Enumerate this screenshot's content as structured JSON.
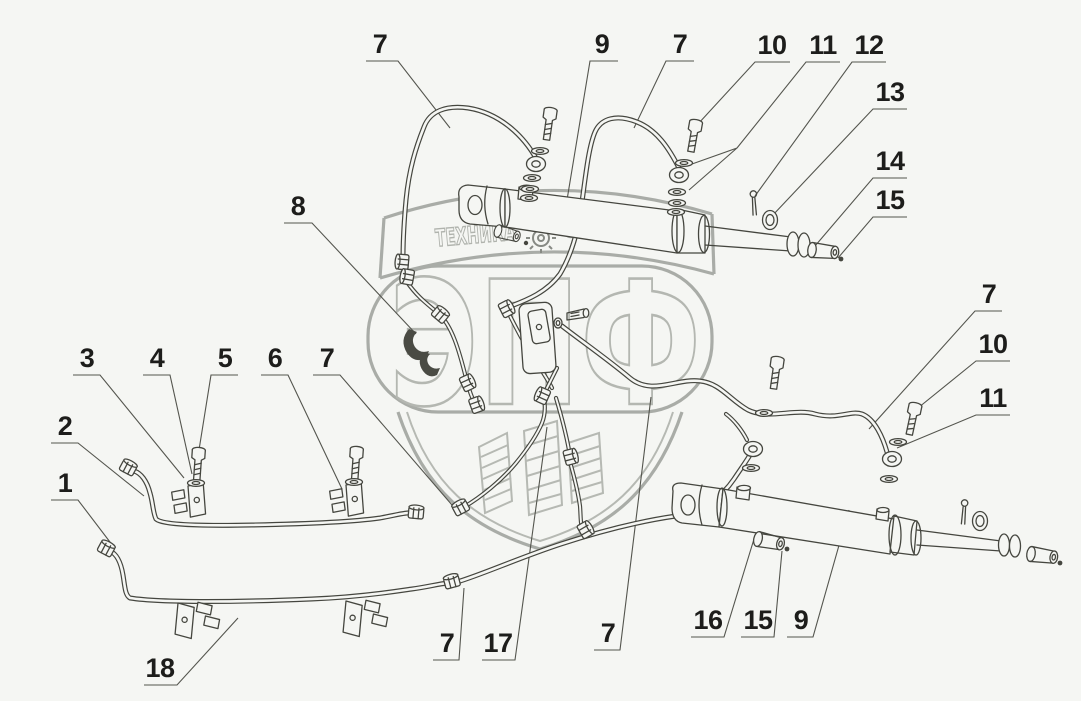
{
  "watermark": {
    "brand_text": "ЭПФ",
    "tagline_left": "ТЕХНИКА",
    "tagline_right": "ЗАПЧАСТИ",
    "gear_icon": "gear-icon"
  },
  "colors": {
    "background": "#f5f6f3",
    "line_art": "#45463f",
    "watermark_gray": "#a9aca7",
    "label_text": "#1d1d1b"
  },
  "callouts": [
    "7",
    "9",
    "7",
    "10",
    "11",
    "12",
    "13",
    "14",
    "15",
    "7",
    "10",
    "11",
    "8",
    "3",
    "4",
    "5",
    "6",
    "7",
    "2",
    "1",
    "18",
    "7",
    "17",
    "7",
    "16",
    "15",
    "9"
  ]
}
